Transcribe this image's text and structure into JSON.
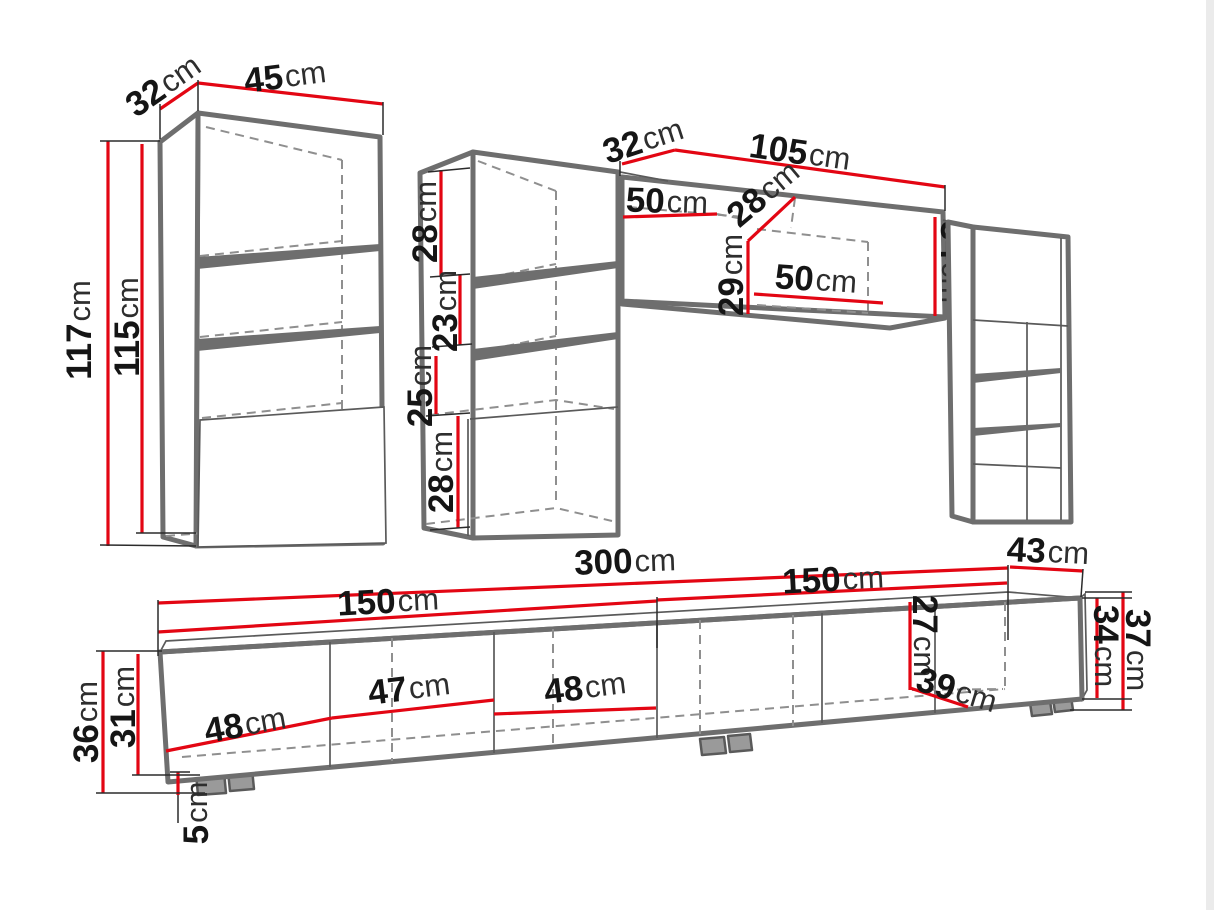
{
  "unit": "cm",
  "accent_color": "#e30613",
  "outline_color": "#6e6e6e",
  "labels": {
    "left_cabinet": {
      "depth": "32",
      "width": "45",
      "height": "117",
      "inner_height": "115"
    },
    "middle_column": {
      "top": "28",
      "upper": "23",
      "middle": "25",
      "bottom": "28"
    },
    "wall_cabinet": {
      "depth": "32",
      "width": "105",
      "left_door": "50",
      "inner_depth": "28",
      "inner_height": "29",
      "right_door": "50",
      "end_height": "34"
    },
    "tv_stand": {
      "total_length": "300",
      "left_length": "150",
      "right_length": "150",
      "depth": "43",
      "height": "36",
      "inner_height": "31",
      "door_a": "48",
      "door_b": "47",
      "door_c": "48",
      "right_inner_height": "27",
      "right_inner_depth": "39",
      "end_inner_height": "34",
      "end_height": "37",
      "foot_height": "5"
    }
  }
}
